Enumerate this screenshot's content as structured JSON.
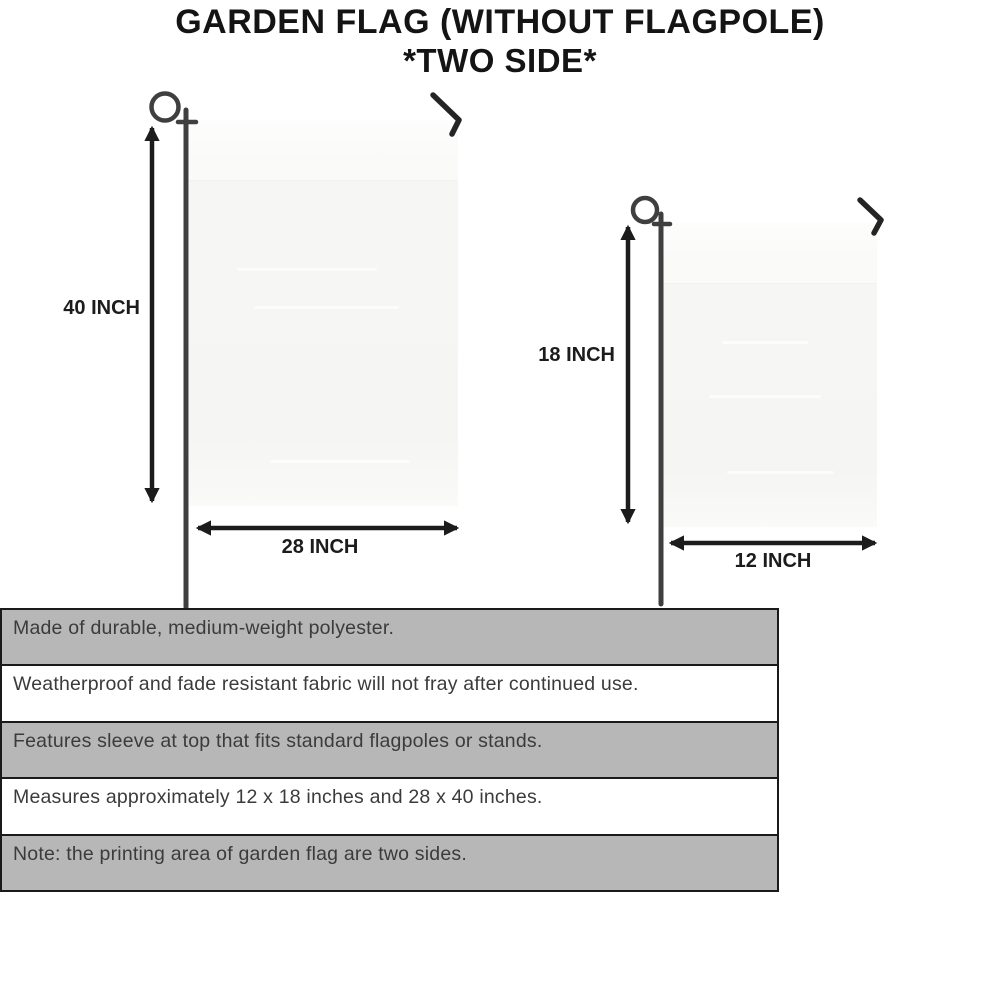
{
  "title": {
    "line1": "GARDEN FLAG (WITHOUT FLAGPOLE)",
    "line2": "*TWO SIDE*"
  },
  "diagram": {
    "large_flag": {
      "height_label": "40 INCH",
      "width_label": "28 INCH"
    },
    "small_flag": {
      "height_label": "18 INCH",
      "width_label": "12 INCH"
    }
  },
  "features": [
    "Made of durable, medium-weight polyester.",
    "Weatherproof and fade resistant fabric will not fray after continued use.",
    "Features sleeve at top that fits standard flagpoles or stands.",
    "Measures approximately 12 x 18 inches and 28 x 40 inches.",
    "Note: the printing area of garden flag are two sides."
  ],
  "colors": {
    "row_gray": "#b7b7b7",
    "row_white": "#ffffff",
    "table_border": "#1a1a1a",
    "flag_fill": "#f6f6f5",
    "pole_wire": "#3f3f3f",
    "ink": "#1c1c1c"
  }
}
